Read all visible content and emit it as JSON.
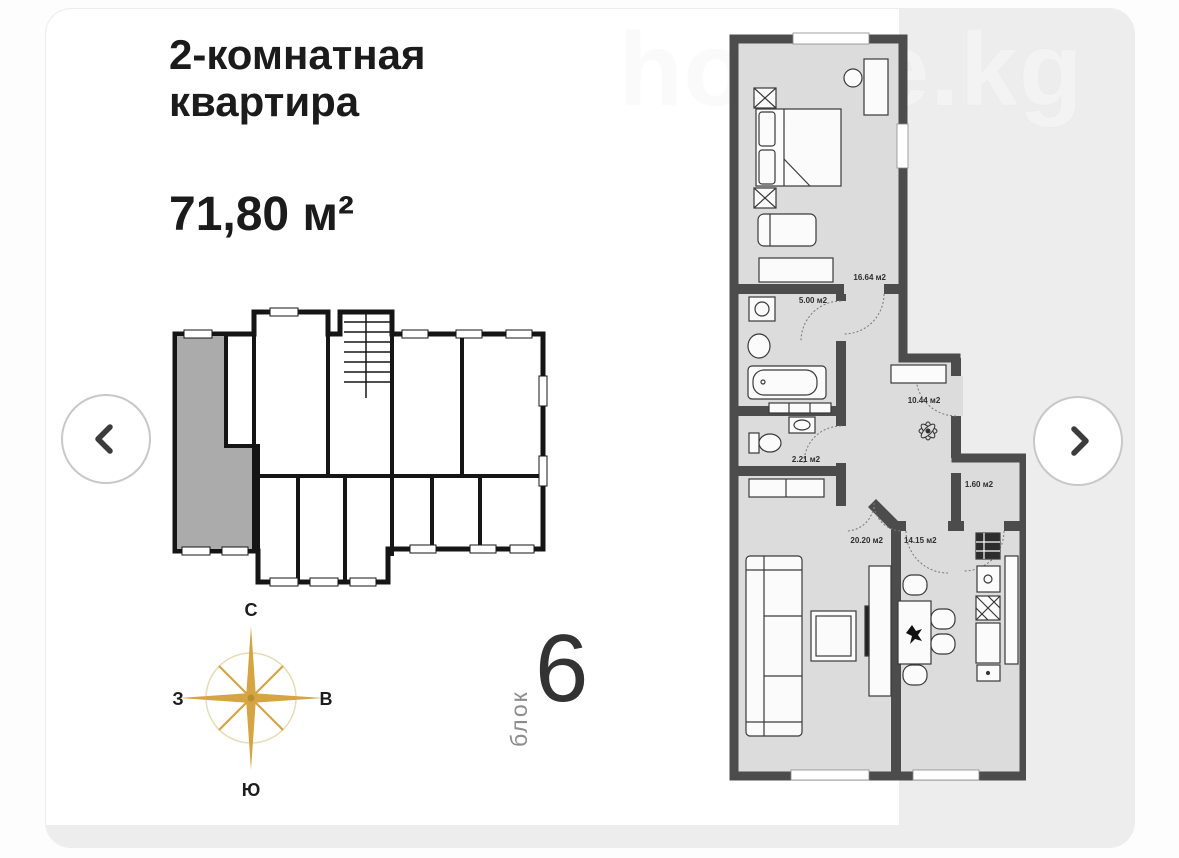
{
  "card": {
    "title_line1": "2-комнатная",
    "title_line2": "квартира",
    "area": "71,80 м²",
    "block_label": "блок",
    "block_number": "6",
    "watermark": "house.kg"
  },
  "compass": {
    "north": "С",
    "south": "Ю",
    "west": "З",
    "east": "В"
  },
  "floor_plan": {
    "room_labels": [
      "16.64 м2",
      "5.00 м2",
      "2.21 м2",
      "10.44 м2",
      "1.60 м2",
      "20.20 м2",
      "14.15 м2"
    ]
  },
  "colors": {
    "accent_gold": "#d4a542",
    "wall_dark": "#4c4c4c",
    "room_fill": "#dcdcdc",
    "highlight_unit": "#ababab",
    "gray_panel": "#ededed"
  }
}
